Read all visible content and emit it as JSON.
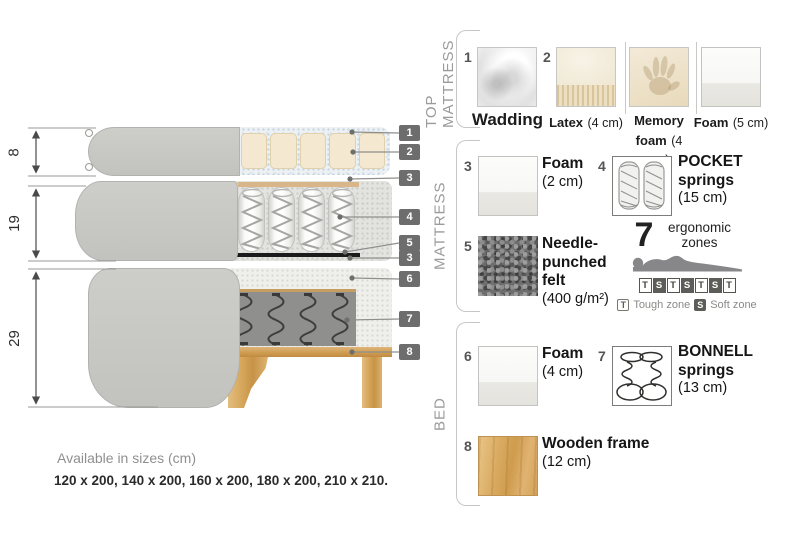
{
  "diagram": {
    "dims": [
      "8",
      "19",
      "29"
    ],
    "callouts": [
      "1",
      "2",
      "3",
      "4",
      "5",
      "3",
      "6",
      "7",
      "8"
    ]
  },
  "legend": {
    "sections": [
      {
        "title": "TOP MATTRESS",
        "items": [
          {
            "num": "1",
            "name": "Wadding",
            "size": ""
          },
          {
            "num": "2",
            "name": "Latex",
            "size": "(4 cm)"
          },
          {
            "num": "",
            "name": "Memory foam",
            "size": "(4 cm)"
          },
          {
            "num": "",
            "name": "Foam",
            "size": "(5 cm)"
          }
        ]
      },
      {
        "title": "MATTRESS",
        "items": [
          {
            "num": "3",
            "name": "Foam",
            "size": "(2 cm)"
          },
          {
            "num": "4",
            "name": "POCKET springs",
            "size": "(15 cm)"
          },
          {
            "num": "5",
            "name": "Needle-punched felt",
            "size": "(400 g/m²)"
          }
        ],
        "zones": {
          "count": "7",
          "label": "ergonomic zones",
          "blocks": [
            "T",
            "S",
            "T",
            "S",
            "T",
            "S",
            "T"
          ],
          "tough_key": "T",
          "tough_label": "Tough zone",
          "soft_key": "S",
          "soft_label": "Soft zone"
        }
      },
      {
        "title": "BED",
        "items": [
          {
            "num": "6",
            "name": "Foam",
            "size": "(4 cm)"
          },
          {
            "num": "7",
            "name": "BONNELL springs",
            "size": "(13 cm)"
          },
          {
            "num": "8",
            "name": "Wooden frame",
            "size": "(12 cm)"
          }
        ]
      }
    ]
  },
  "footer": {
    "title": "Available in sizes (cm)",
    "sizes": "120 x 200, 140 x 200, 160 x 200, 180 x 200, 210 x 210."
  },
  "colors": {
    "fabric": "#c8c8c4",
    "wood": "#d5a55c",
    "callout_chip": "#6d6d6d",
    "felt": "#1b1b1b"
  }
}
